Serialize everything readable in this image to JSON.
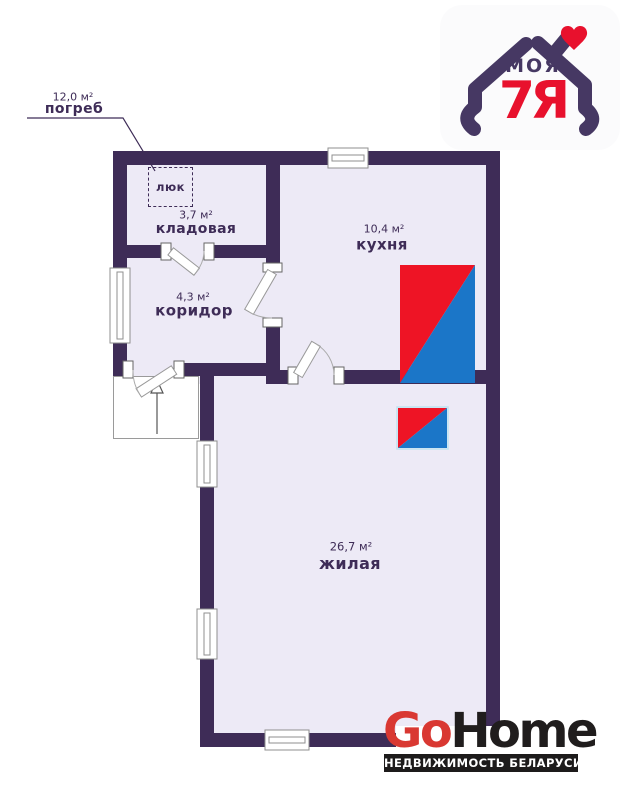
{
  "plan": {
    "colors": {
      "wall": "#3e2c57",
      "floor": "#edeaf6",
      "furnace_red": "#ee1425",
      "furnace_blue": "#1b76c8",
      "label_text": "#3e2c57"
    },
    "rooms": [
      {
        "name": "погреб",
        "area": "12,0 м²"
      },
      {
        "name": "кладовая",
        "area": "3,7 м²"
      },
      {
        "name": "коридор",
        "area": "4,3 м²"
      },
      {
        "name": "кухня",
        "area": "10,4 м²"
      },
      {
        "name": "жилая",
        "area": "26,7 м²"
      }
    ],
    "hatch": {
      "label": "люк"
    }
  },
  "branding": {
    "agency_logo": {
      "word": "МОЯ",
      "word2": "7Я",
      "purple": "#463863",
      "red": "#e8112d"
    },
    "gohome": {
      "part1": "Go",
      "part2": "Home",
      "tagline": "НЕДВИЖИМОСТЬ БЕЛАРУСИ",
      "red": "#d93832",
      "dark": "#201d1d"
    }
  }
}
